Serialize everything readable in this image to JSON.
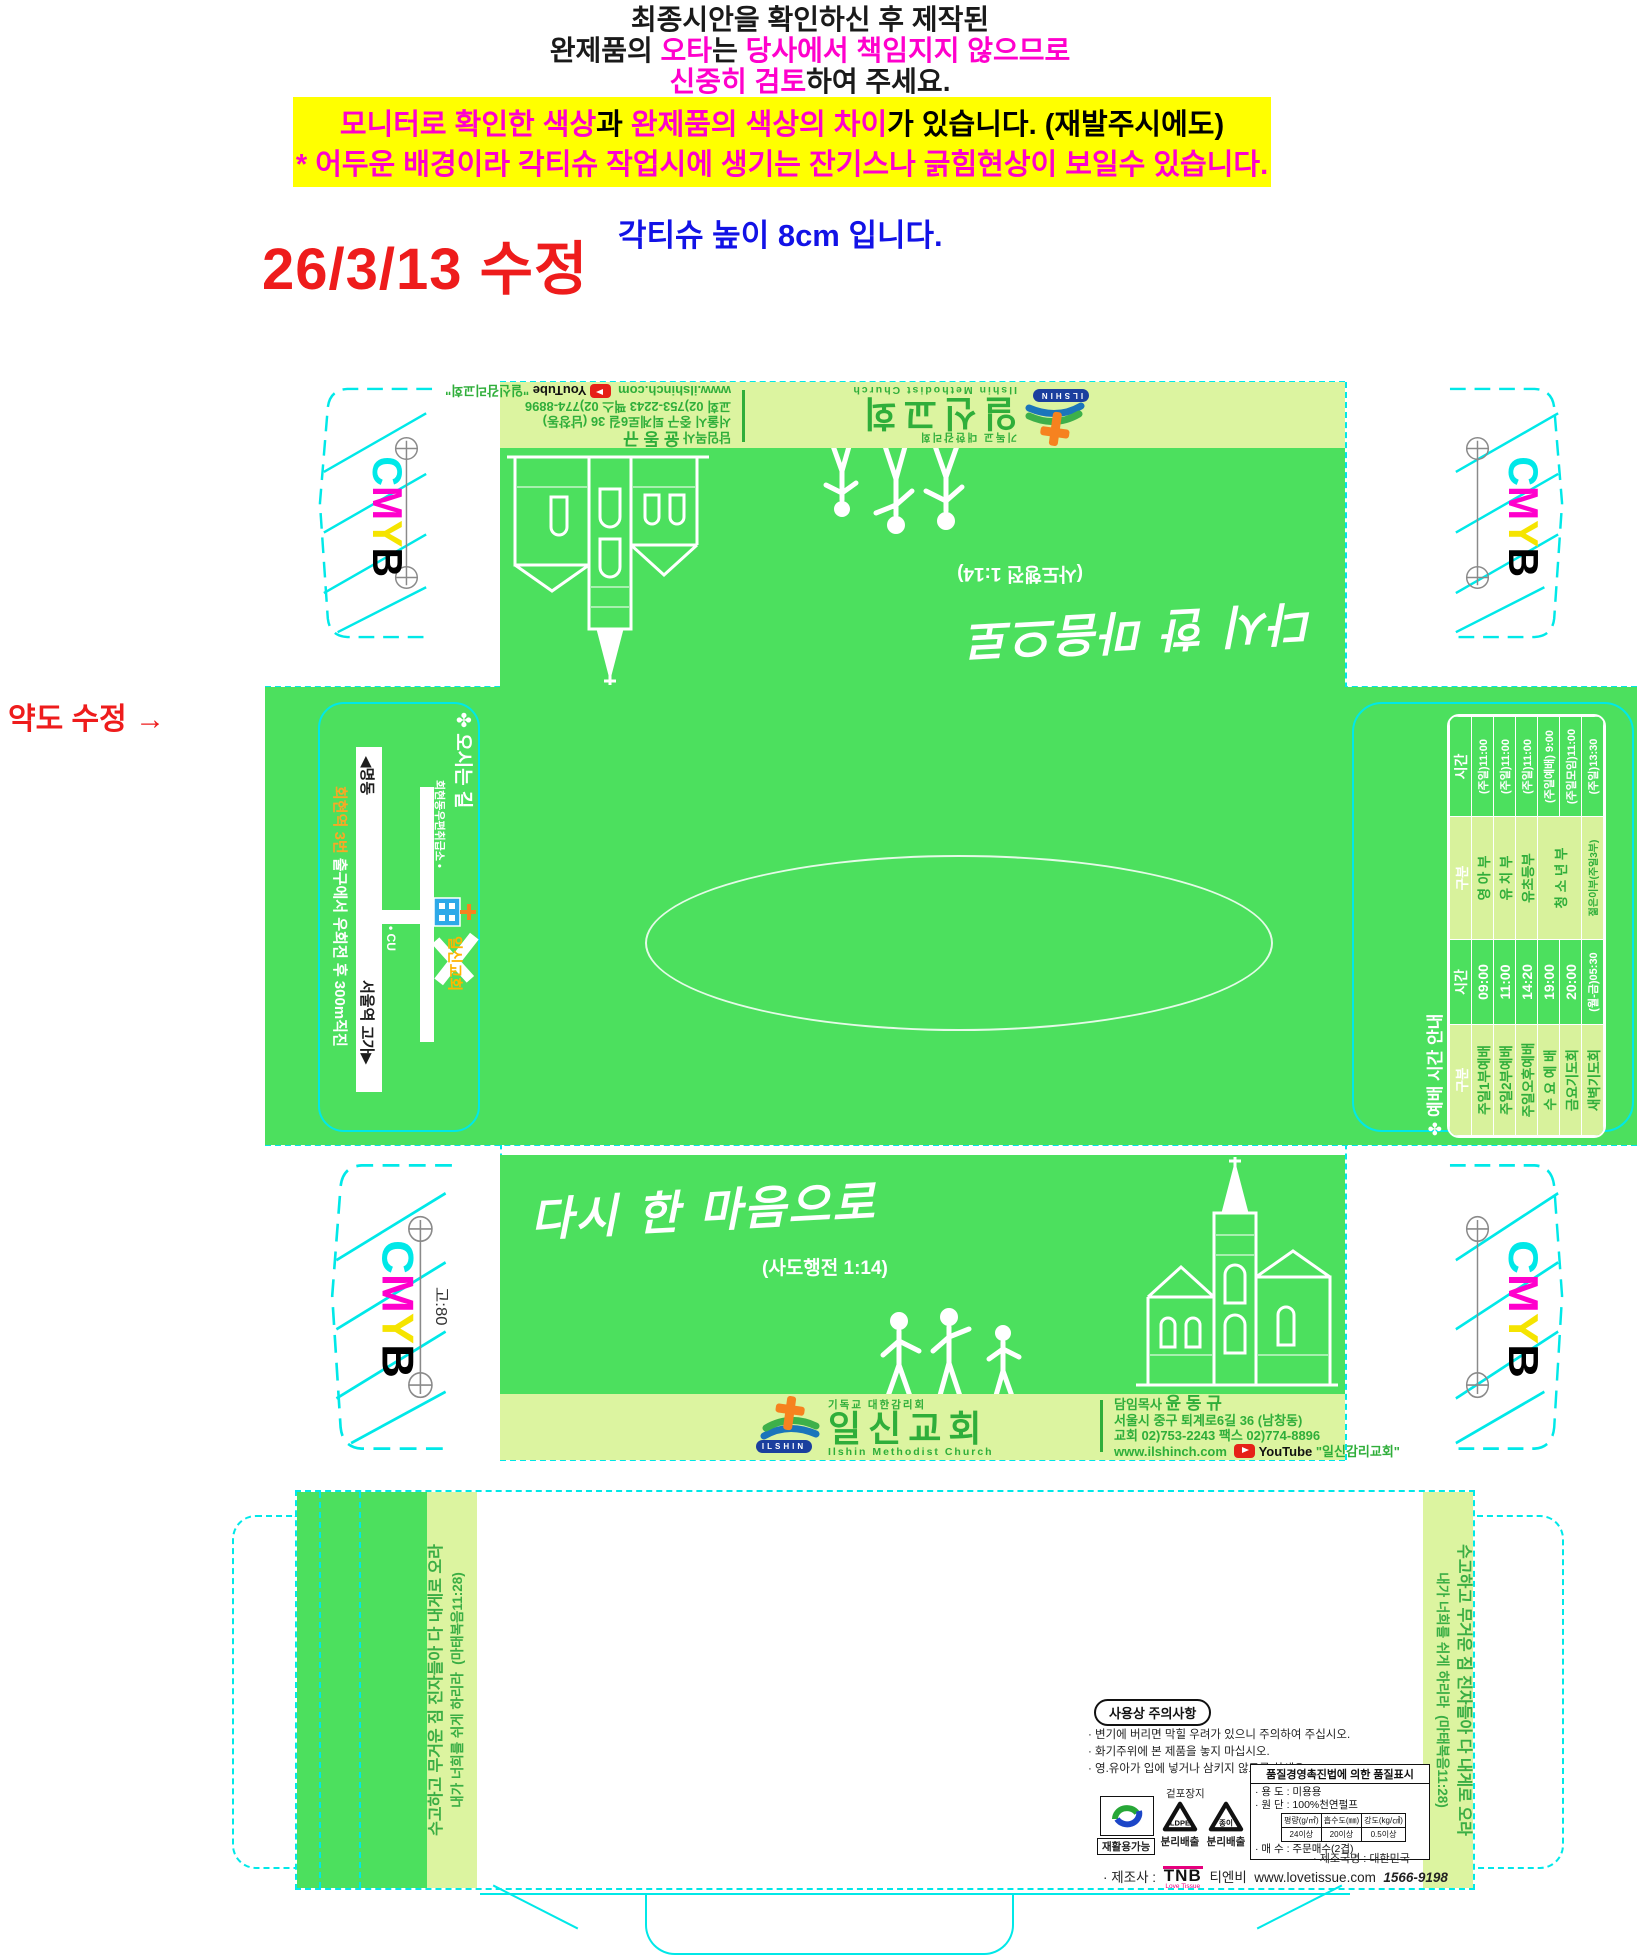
{
  "proof": {
    "line1": "최종시안을 확인하신 후 제작된",
    "line2_a": "완제품의 ",
    "line2_b": "오타",
    "line2_c": "는 ",
    "line2_d": "당사에서 책임지지 않으므로",
    "line3_a": "신중히 검토",
    "line3_b": "하여 주세요.",
    "banner_l1_a": "모니터로 확인한 색상",
    "banner_l1_b": "과  ",
    "banner_l1_c": "완제품의 색상의 차이",
    "banner_l1_d": "가 있습니다. (재발주시에도)",
    "banner_l2_a": "* ",
    "banner_l2_b": "어두운 배경이라  각티슈 작업시에 생기는 잔기스나 긁힘현상이 보일수 있습니다.",
    "revision_date": "26/3/13 수정",
    "height_note": "각티슈 높이 8cm 입니다.",
    "map_revision_note": "약도 수정 →"
  },
  "marks": {
    "cmyb": [
      "C",
      "M",
      "Y",
      "B"
    ],
    "cmyb_colors": {
      "c": "#00e8e8",
      "m": "#ff00cc",
      "y": "#f5e400",
      "b": "#000000"
    },
    "flap_gauge": "고:80"
  },
  "panel": {
    "slogan": "다시 한 마음으로",
    "slogan_ref": "(사도행전 1:14)",
    "footer": {
      "denomination": "기독교 대한감리회",
      "church_name": "일신교회",
      "church_name_en": "Ilshin Methodist Church",
      "badge": "ILSHIN",
      "pastor_label": "담임목사",
      "pastor_name": "윤 동 규",
      "address": "서울시 중구 퇴계로6길 36 (남창동)",
      "phone": "교회 02)753-2243   팩스 02)774-8896",
      "web": "www.ilshinch.com",
      "youtube_label": "YouTube",
      "youtube_channel": "\"일신감리교회\""
    }
  },
  "map": {
    "title": "✤ 오시는 길",
    "road_left": "◀명동",
    "road_right": "서울역 고가▶",
    "direction_hl": "회현역 3번",
    "direction_rest": " 출구에서 우회전 후 300m직진",
    "poi_post_office": "회현동우편취급소 •",
    "poi_cu": "• CU",
    "church_label": "일신교회"
  },
  "schedule": {
    "title": "✤ 예배 시간 안내",
    "headers": [
      "구분",
      "시간",
      "구분",
      "시간"
    ],
    "rows": [
      [
        "주일1부예배",
        "09:00",
        "영 아 부",
        "(주일)11:00"
      ],
      [
        "주일2부예배",
        "11:00",
        "유 치 부",
        "(주일)11:00"
      ],
      [
        "주일오후예배",
        "14:20",
        "유초등부",
        "(주일)11:00"
      ],
      [
        "수 요 예 배",
        "19:00",
        "청 소 년 부",
        "(주일예배) 9:00"
      ],
      [
        "금요기도회",
        "20:00",
        "",
        "(주일모임)11:00"
      ],
      [
        "새벽기도회",
        "(월-금)05:30",
        "젊은이부(주일3부)",
        "(주일)13:30"
      ]
    ]
  },
  "verse": {
    "line1": "수고하고 무거운 짐 진자들아 다 내게로 오라",
    "line2": "내가 너희를 쉬게 하리라",
    "ref": "(마태복음11:28)"
  },
  "care": {
    "title": "사용상 주의사항",
    "items": [
      "· 변기에 버리면 막힐 우려가 있으니 주의하여 주십시오.",
      "· 화기주위에 본 제품을 놓지 마십시오.",
      "· 영.유아가 입에 넣거나 삼키지 않도록 하세요."
    ],
    "recycle_ok": "재활용가능",
    "wrap_label": "겉포장지",
    "recycle1_material": "LDPE",
    "recycle1_label": "분리배출",
    "recycle2_material": "종이",
    "recycle2_label": "분리배출",
    "quality": {
      "header": "품질경영촉진법에 의한 품질표시",
      "use": "· 용  도 : 미용용",
      "material": "· 원  단 : 100%천연펄프",
      "spec_headers": [
        "평량(g/㎡)",
        "흡수도(㎜)",
        "강도(kg/㎠)"
      ],
      "spec_values": [
        "24이상",
        "20이상",
        "0.5이상"
      ],
      "count": "· 매  수 : 주문매수(2겹)"
    },
    "origin": "· 제조국명 : 대한민국",
    "maker_label": "· 제조사 :",
    "maker_logo": "TNB",
    "maker_logo_sub": "Love Tissue",
    "maker_name": "티엔비",
    "maker_web": "www.lovetissue.com",
    "maker_tel": "1566-9198"
  }
}
